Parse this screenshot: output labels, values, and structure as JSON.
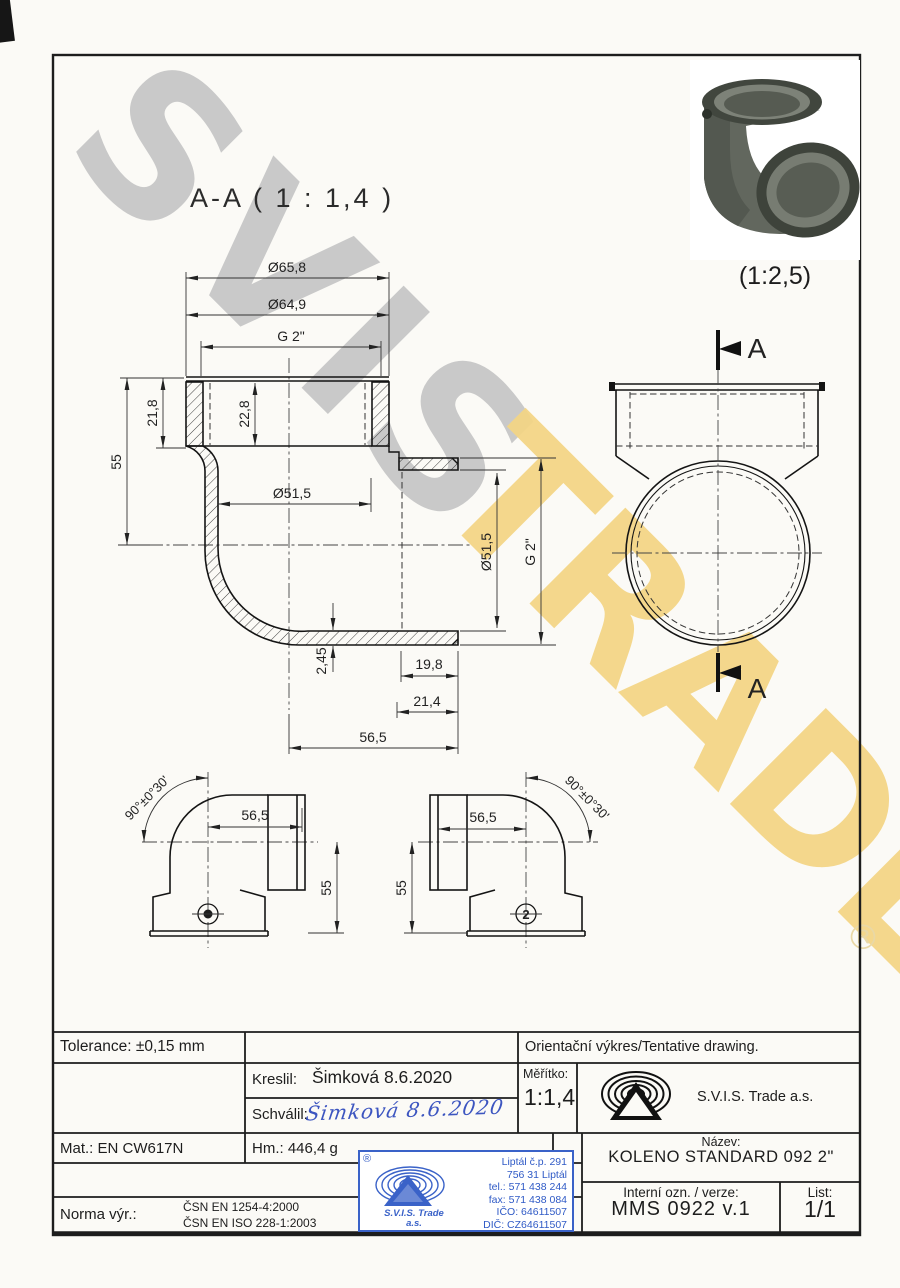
{
  "watermark": {
    "word1": "SVIS",
    "word2": "TRADE",
    "registered": "®"
  },
  "drawing": {
    "section_title": "A-A ( 1 : 1,4 )",
    "photo_scale": "(1:2,5)",
    "section_marks": {
      "top": "A",
      "bottom": "A"
    },
    "mold_mark": "2",
    "dims": {
      "top1": "Ø65,8",
      "top2": "Ø64,9",
      "top3": "G 2\"",
      "left55": "55",
      "l218": "21,8",
      "l228": "22,8",
      "bore": "Ø51,5",
      "outlet_bore": "Ø51,5",
      "outlet_g2": "G 2\"",
      "wall": "2,45",
      "t198": "19,8",
      "t214": "21,4",
      "t565": "56,5",
      "v1_angle": "90°±0°30'",
      "v1_565": "56,5",
      "v1_55": "55",
      "v2_565": "56,5",
      "v2_55": "55",
      "v2_angle": "90°±0°30'"
    }
  },
  "title_block": {
    "tolerance": "Tolerance: ±0,15 mm",
    "orientacni": "Orientační výkres/Tentative drawing.",
    "kreslil_label": "Kreslil:",
    "kreslil_value": "Šimková 8.6.2020",
    "schvalil_label": "Schválil:",
    "schvalil_signature": "Šimková 8.6.2020",
    "meritko_label": "Měřítko:",
    "meritko_value": "1:1,4",
    "company": "S.V.I.S. Trade a.s.",
    "mat": "Mat.: EN CW617N",
    "hm": "Hm.: 446,4 g",
    "nazev_label": "Název:",
    "nazev_value": "KOLENO STANDARD 092 2\"",
    "interni_label": "Interní ozn. / verze:",
    "interni_value": "MMS 0922 v.1",
    "list_label": "List:",
    "list_value": "1/1",
    "norma_label": "Norma výr.:",
    "norma_line1": "ČSN EN 1254-4:2000",
    "norma_line2": "ČSN EN ISO 228-1:2003"
  },
  "stamp": {
    "registered": "®",
    "company_line1": "S.V.I.S. Trade",
    "company_line2": "a.s.",
    "address": [
      "Liptál č.p. 291",
      "756 31 Liptál",
      "tel.: 571 438 244",
      "fax: 571 438 084",
      "IČO: 64611507",
      "DIČ: CZ64611507"
    ]
  }
}
